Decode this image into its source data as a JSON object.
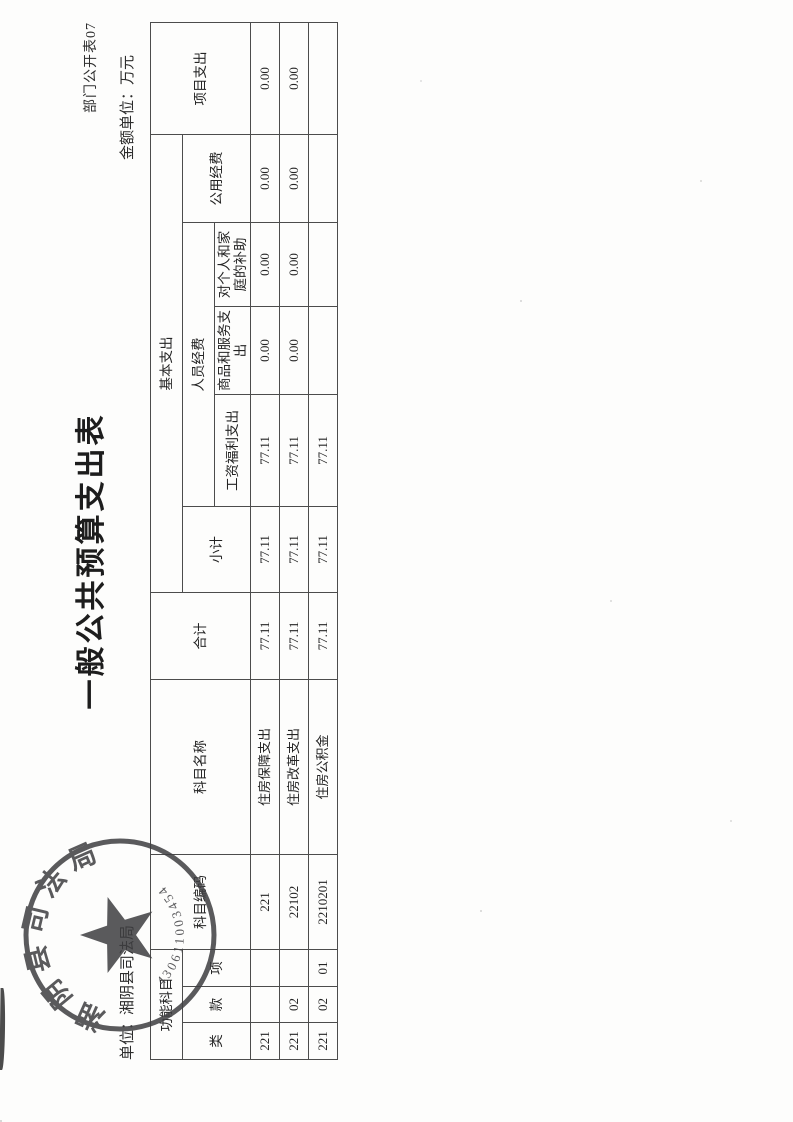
{
  "page": {
    "doc_number": "部门公开表07",
    "title": "一般公共预算支出表",
    "unit_label": "单位：湘阴县司法局",
    "amount_unit_label": "金额单位：万元"
  },
  "table": {
    "headers": {
      "func_group": "功能科目",
      "cls": "类",
      "sec": "款",
      "itm": "项",
      "code": "科目编码",
      "name": "科目名称",
      "total": "合计",
      "basic": "基本支出",
      "subtotal": "小计",
      "personnel": "人员经费",
      "wages": "工资福利支出",
      "goods": "商品和服务支出",
      "family": "对个人和家庭的补助",
      "public": "公用经费",
      "project": "项目支出"
    },
    "rows": [
      {
        "cls": "221",
        "sec": "",
        "itm": "",
        "code": "221",
        "name": "住房保障支出",
        "total": "77.11",
        "subtotal": "77.11",
        "wages": "77.11",
        "goods": "0.00",
        "family": "0.00",
        "public": "0.00",
        "project": "0.00"
      },
      {
        "cls": "221",
        "sec": "02",
        "itm": "",
        "code": "22102",
        "name": "住房改革支出",
        "total": "77.11",
        "subtotal": "77.11",
        "wages": "77.11",
        "goods": "0.00",
        "family": "0.00",
        "public": "0.00",
        "project": "0.00"
      },
      {
        "cls": "221",
        "sec": "02",
        "itm": "01",
        "code": "2210201",
        "name": "住房公积金",
        "total": "77.11",
        "subtotal": "77.11",
        "wages": "77.11",
        "goods": "",
        "family": "",
        "public": "",
        "project": ""
      }
    ]
  },
  "stamp": {
    "org": "湘阴县司法局",
    "code_digits": "430611003454"
  },
  "colors": {
    "ink": "#262626",
    "grid_line": "#4c4c4c",
    "stamp_ink": "#3e3e41"
  }
}
